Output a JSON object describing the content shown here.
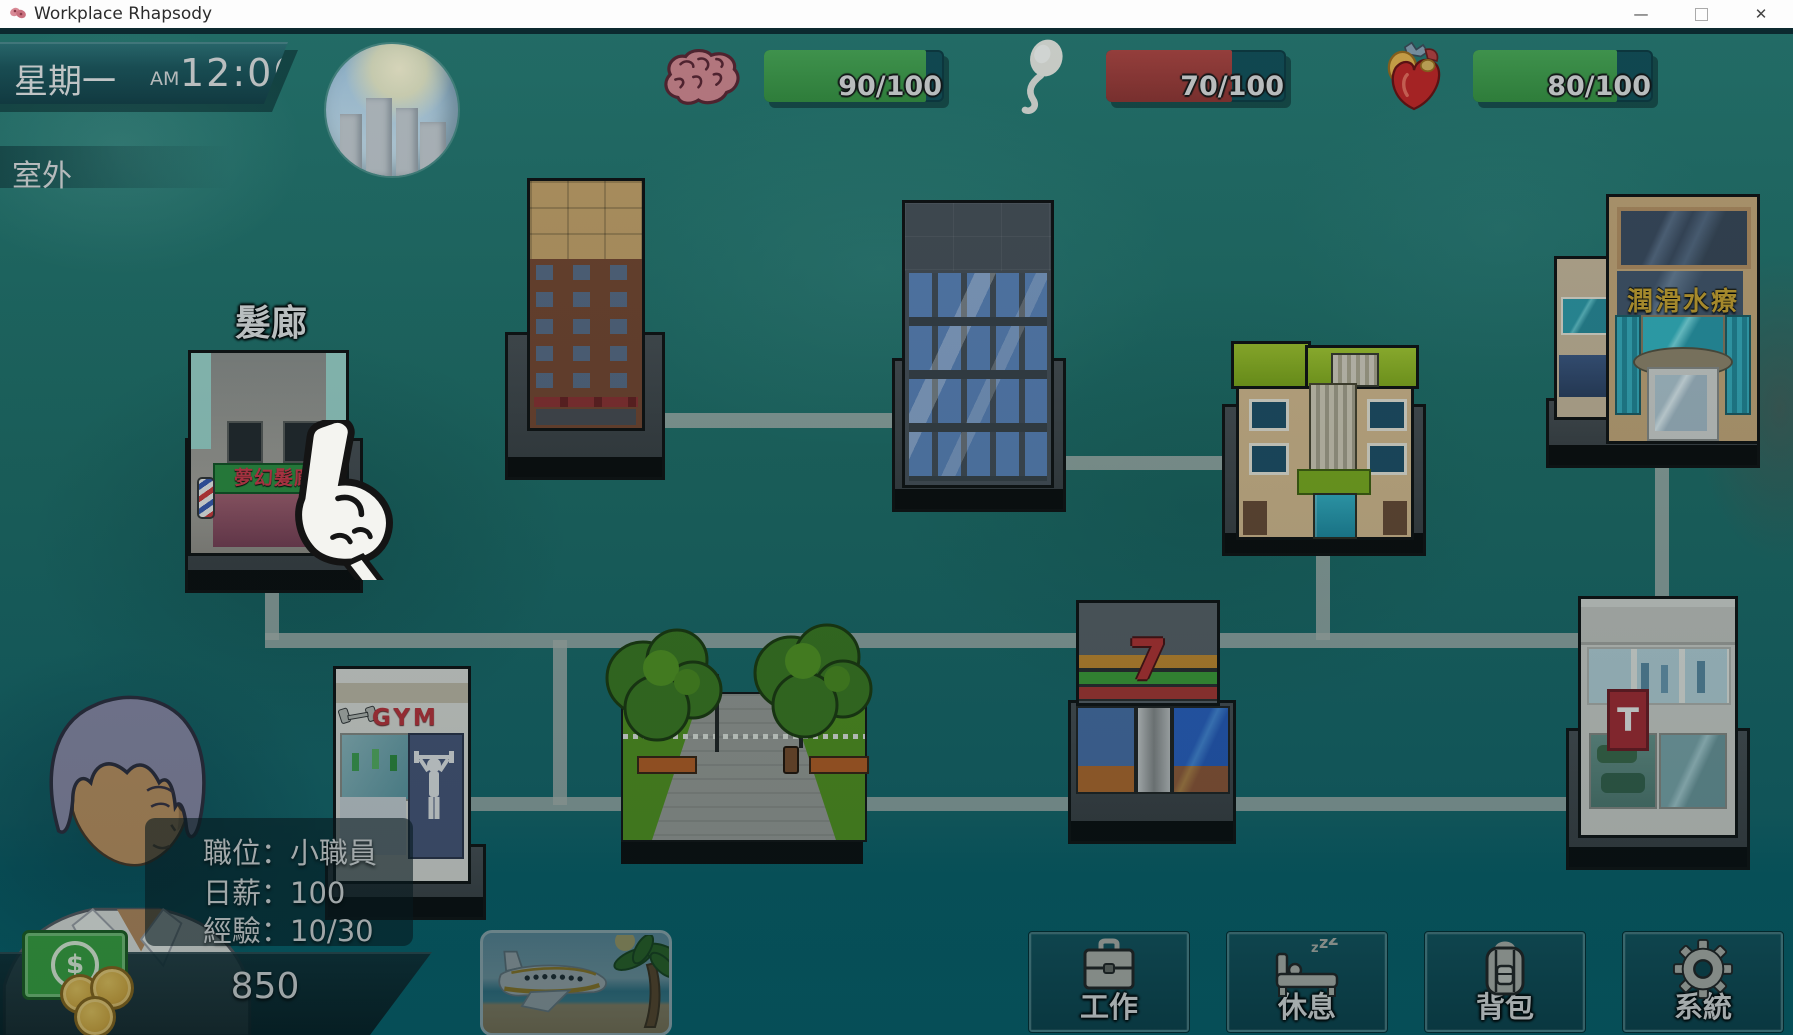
{
  "window": {
    "title": "Workplace Rhapsody",
    "minimize": "—",
    "close": "✕"
  },
  "hud": {
    "day": "星期一",
    "meridiem": "AM",
    "time": "12:00",
    "location": "室外",
    "stats": [
      {
        "icon": "brain-icon",
        "value": "90/100",
        "percent": 90,
        "color": "#3f9e4d"
      },
      {
        "icon": "sperm-icon",
        "value": "70/100",
        "percent": 70,
        "color": "#a63c38"
      },
      {
        "icon": "heart-icon",
        "value": "80/100",
        "percent": 80,
        "color": "#3f9e4d"
      }
    ]
  },
  "map": {
    "salon": {
      "label": "髮廊",
      "sign": "夢幻髮廊"
    },
    "spa": {
      "sign": "潤滑水療"
    },
    "gym": {
      "sign": "GYM"
    },
    "seven": {
      "sign": "7"
    },
    "tstore": {
      "sign": "T"
    }
  },
  "player": {
    "job_label": "職位：",
    "job": "小職員",
    "wage_label": "日薪：",
    "wage": "100",
    "exp_label": "經驗：",
    "exp": "10/30",
    "money": "850"
  },
  "actions": [
    {
      "label": "工作",
      "icon": "briefcase-icon"
    },
    {
      "label": "休息",
      "icon": "bed-icon"
    },
    {
      "label": "背包",
      "icon": "backpack-icon"
    },
    {
      "label": "系統",
      "icon": "gear-icon"
    }
  ],
  "colors": {
    "bar_green": "#3f9e4d",
    "bar_red": "#a63c38",
    "salon_sign_green": "#2e8f3f",
    "salon_sign_text": "#d03848",
    "spa_gold": "#c8a22e",
    "seven_red": "#b02828",
    "t_sign_red": "#a82830"
  }
}
